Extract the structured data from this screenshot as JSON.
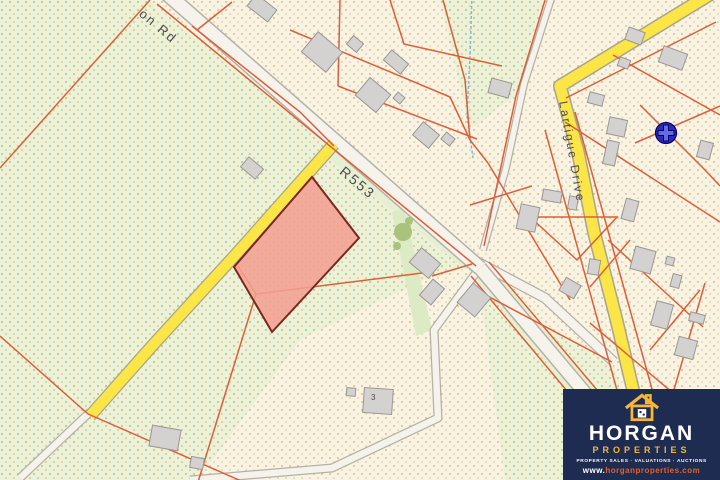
{
  "map": {
    "labels": [
      {
        "name": "road-label-on-rd",
        "text": "on Rd",
        "x": 146,
        "y": 6,
        "rot": 40,
        "size": 13
      },
      {
        "name": "road-label-r553",
        "text": "R553",
        "x": 347,
        "y": 163,
        "rot": 40,
        "size": 14
      },
      {
        "name": "road-label-lartigue-drive",
        "text": "Lartigue Drive",
        "x": 570,
        "y": 100,
        "rot": 80,
        "size": 12
      },
      {
        "name": "house-number",
        "text": "3",
        "x": 371,
        "y": 393,
        "rot": 0,
        "size": 8
      }
    ],
    "colors": {
      "cream_bg": "#f8f3e2",
      "cream_dot1": "#ddab6a",
      "cream_dot2": "#cfc393",
      "green_bg": "#ecf2d7",
      "green_dot1": "#a9b478",
      "green_dot2": "#d8a868",
      "road_fill": "#f6f3ec",
      "road_border": "#b5b1a6",
      "yellow_fill": "#fbe547",
      "yellow_border": "#a8a48f",
      "parcel_line": "#dd5f3a",
      "building_fill": "#d4d1d1",
      "building_border": "#9a9794",
      "highlight_fill": "#f2a093",
      "highlight_border": "#7a2720",
      "verge_green": "#e6efd2",
      "tree_green": "#dcebc4",
      "tree_blob": "#a9c27c",
      "stream_blue": "#8ab4d4",
      "marker_outer": "#2a2ab2",
      "marker_cross": "#6868e0",
      "marker_edge": "#000070"
    },
    "geometry": {
      "greens": [
        "0,0 148,0 340,153 472,264 430,277 300,340 198,480 0,480",
        "440,0 543,0 516,95 470,130",
        "480,292 612,362 655,480 505,480"
      ],
      "verges": [
        {
          "color": "verge_green",
          "pts": "336,150 474,262 466,270 328,158"
        },
        {
          "color": "tree_green",
          "pts": "392,212 404,208 432,330 416,336"
        }
      ],
      "under_strokes": [
        {
          "path": [
            [
              480,
              268
            ],
            [
              660,
              482
            ]
          ],
          "w": 20,
          "color": "verge_green"
        }
      ],
      "roads": [
        {
          "name": "lane-bottom-left",
          "path": [
            [
              90,
              412
            ],
            [
              20,
              478
            ]
          ],
          "wo": 9,
          "wi": 6.5,
          "type": "white"
        },
        {
          "name": "lane-loop",
          "path": [
            [
              478,
              270
            ],
            [
              434,
              330
            ],
            [
              438,
              418
            ],
            [
              332,
              468
            ],
            [
              190,
              480
            ]
          ],
          "wo": 9,
          "wi": 6.5,
          "type": "white"
        },
        {
          "name": "lane-north",
          "path": [
            [
              552,
              -4
            ],
            [
              524,
              84
            ],
            [
              506,
              168
            ],
            [
              483,
              250
            ]
          ],
          "wo": 8,
          "wi": 5.5,
          "type": "white"
        },
        {
          "name": "road-side-east",
          "path": [
            [
              470,
              258
            ],
            [
              545,
              298
            ],
            [
              614,
              362
            ]
          ],
          "wo": 11,
          "wi": 8.5,
          "type": "white"
        },
        {
          "name": "road-r553-south",
          "path": [
            [
              480,
              268
            ],
            [
              660,
              482
            ]
          ],
          "wo": 15,
          "wi": 12,
          "type": "white"
        },
        {
          "name": "road-r553",
          "path": [
            [
              165,
              -8
            ],
            [
              480,
              268
            ]
          ],
          "wo": 16,
          "wi": 13,
          "type": "white"
        },
        {
          "name": "road-yellow-left",
          "path": [
            [
              334,
              144
            ],
            [
              238,
              252
            ],
            [
              152,
              346
            ],
            [
              90,
              416
            ]
          ],
          "wo": 13,
          "wi": 10.5,
          "type": "yellow"
        },
        {
          "name": "road-lartigue-drive",
          "path": [
            [
              714,
              -8
            ],
            [
              560,
              86
            ],
            [
              578,
              152
            ],
            [
              594,
              232
            ],
            [
              616,
              318
            ],
            [
              642,
              428
            ],
            [
              655,
              484
            ]
          ],
          "wo": 14,
          "wi": 11,
          "type": "yellow"
        }
      ],
      "stream": [
        [
          472,
          -4
        ],
        [
          470,
          56
        ],
        [
          467,
          116
        ],
        [
          473,
          158
        ]
      ],
      "tree_blobs": [
        [
          403,
          232,
          9
        ],
        [
          397,
          246,
          4
        ],
        [
          409,
          221,
          4
        ]
      ],
      "parcel_lines": [
        [
          150,
          0,
          0,
          168
        ],
        [
          157,
          4,
          476,
          266
        ],
        [
          197,
          30,
          232,
          2
        ],
        [
          192,
          26,
          300,
          112,
          334,
          146
        ],
        [
          290,
          30,
          450,
          97,
          470,
          140
        ],
        [
          340,
          0,
          338,
          86
        ],
        [
          338,
          86,
          477,
          139
        ],
        [
          390,
          0,
          404,
          44,
          502,
          66
        ],
        [
          443,
          0,
          465,
          80,
          470,
          140
        ],
        [
          545,
          0,
          516,
          96,
          484,
          246
        ],
        [
          470,
          140,
          488,
          163,
          570,
          300
        ],
        [
          470,
          205,
          532,
          186
        ],
        [
          530,
          217,
          577,
          260,
          617,
          217,
          530,
          217
        ],
        [
          566,
          98,
          716,
          22
        ],
        [
          613,
          55,
          720,
          115
        ],
        [
          565,
          122,
          720,
          222
        ],
        [
          575,
          112,
          655,
          400
        ],
        [
          545,
          130,
          628,
          430
        ],
        [
          635,
          143,
          720,
          106
        ],
        [
          640,
          105,
          705,
          170,
          720,
          186
        ],
        [
          608,
          240,
          703,
          327
        ],
        [
          630,
          240,
          590,
          287
        ],
        [
          590,
          323,
          673,
          393
        ],
        [
          705,
          283,
          673,
          393
        ],
        [
          700,
          290,
          650,
          350
        ],
        [
          0,
          336,
          88,
          414
        ],
        [
          88,
          414,
          255,
          487
        ],
        [
          238,
          266,
          256,
          294
        ],
        [
          256,
          294,
          430,
          272
        ],
        [
          256,
          294,
          198,
          482
        ],
        [
          472,
          264,
          432,
          276
        ],
        [
          489,
          262,
          668,
          474
        ],
        [
          471,
          276,
          648,
          488
        ],
        [
          480,
          292,
          612,
          362
        ]
      ],
      "buildings": [
        [
          262,
          8,
          26,
          15,
          38
        ],
        [
          322,
          52,
          32,
          26,
          40
        ],
        [
          355,
          44,
          13,
          11,
          40
        ],
        [
          396,
          62,
          22,
          13,
          40
        ],
        [
          373,
          95,
          27,
          23,
          40
        ],
        [
          399,
          98,
          9,
          8,
          40
        ],
        [
          426,
          135,
          21,
          17,
          40
        ],
        [
          448,
          139,
          11,
          9,
          40
        ],
        [
          635,
          36,
          17,
          13,
          20
        ],
        [
          673,
          58,
          25,
          17,
          20
        ],
        [
          624,
          63,
          11,
          9,
          20
        ],
        [
          500,
          88,
          21,
          15,
          15
        ],
        [
          596,
          99,
          15,
          11,
          15
        ],
        [
          617,
          127,
          18,
          17,
          12
        ],
        [
          611,
          153,
          12,
          24,
          12
        ],
        [
          552,
          196,
          19,
          11,
          10
        ],
        [
          573,
          203,
          9,
          13,
          10
        ],
        [
          528,
          218,
          19,
          25,
          12
        ],
        [
          630,
          210,
          13,
          21,
          15
        ],
        [
          705,
          150,
          13,
          17,
          15
        ],
        [
          643,
          260,
          21,
          23,
          15
        ],
        [
          670,
          261,
          8,
          8,
          15
        ],
        [
          676,
          281,
          9,
          13,
          15
        ],
        [
          662,
          315,
          17,
          25,
          15
        ],
        [
          697,
          318,
          15,
          9,
          15
        ],
        [
          686,
          348,
          19,
          19,
          15
        ],
        [
          594,
          267,
          11,
          15,
          10
        ],
        [
          570,
          288,
          17,
          15,
          30
        ],
        [
          425,
          263,
          25,
          19,
          40
        ],
        [
          432,
          292,
          15,
          21,
          40
        ],
        [
          474,
          300,
          23,
          25,
          40
        ],
        [
          378,
          401,
          29,
          25,
          4
        ],
        [
          351,
          392,
          9,
          8,
          4
        ],
        [
          165,
          438,
          29,
          21,
          10
        ],
        [
          197,
          463,
          13,
          11,
          10
        ],
        [
          252,
          168,
          19,
          13,
          40
        ]
      ],
      "highlight_parcel": "312,177 359,238 272,332 234,267",
      "marker": {
        "x": 666,
        "y": 133,
        "r": 10.5
      }
    }
  },
  "logo": {
    "bg": "#1f2c52",
    "accent": "#f5b63a",
    "brand": "HORGAN",
    "sub": "PROPERTIES",
    "services": "PROPERTY SALES · VALUATIONS · AUCTIONS",
    "site_prefix": "www.",
    "site": "horganproperties.com",
    "site_color": "#e0622d"
  }
}
